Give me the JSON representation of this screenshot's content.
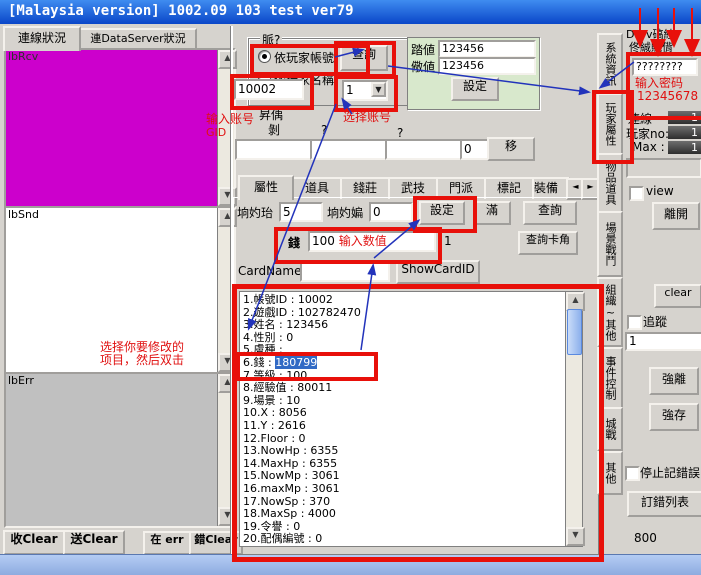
{
  "window": {
    "title": "[Malaysia version] 1002.09   103 test ver79"
  },
  "left_tabs": {
    "tab1": "連線狀況",
    "tab2": "連DataServer狀況"
  },
  "listboxes": {
    "rcv_label": "lbRcv",
    "snd_label": "lbSnd",
    "err_label": "lbErr"
  },
  "bottom_buttons": {
    "rcv_clear": "收Clear",
    "snd_clear": "送Clear",
    "err": "在 err",
    "err_clear": "錯Clear"
  },
  "query_group": {
    "title": "脈?",
    "radio_by_account": "依玩家帳號",
    "radio_by_name": "依玩家名稱",
    "query_button": "查詢",
    "account_value": "10002",
    "account_select_value": "1"
  },
  "value_group": {
    "row1_label": "踏値",
    "row1_value": "123456",
    "row2_label": "儆値",
    "row2_value": "123456",
    "set_button": "設定"
  },
  "transfer_row": {
    "label_top": "昇偊",
    "label_left": "剝",
    "q1": "?",
    "q2": "?",
    "input1": "",
    "input2": "",
    "input3": "",
    "count_value": "0",
    "move_button": "移"
  },
  "attr_tabs": {
    "tabs": [
      "屬性",
      "道具",
      "錢莊",
      "武技",
      "門派",
      "標記",
      "裝備"
    ]
  },
  "attribute_tab": {
    "field1_label": "垧妁珆",
    "field1_value": "5",
    "field2_label": "垧妁媥",
    "field2_value": "0",
    "set_button": "設定",
    "full_button": "滿",
    "query_button": "查詢",
    "money_label": "錢",
    "money_value": "100",
    "count_label": "1",
    "query_card_button": "查詢卡角",
    "cardname_label": "CardName",
    "cardname_value": "",
    "showcardid_button": "ShowCardID"
  },
  "player_list": {
    "items": [
      "1.帳號ID : 10002",
      "2.遊戲ID : 102782470",
      "3.姓名 : 123456",
      "4.性別 : 0",
      "5.膚種 :",
      "6.錢 : 180799",
      "7.等級 : 100",
      "8.經驗值 : 80011",
      "9.場景 : 10",
      "10.X : 8056",
      "11.Y : 2616",
      "12.Floor : 0",
      "13.NowHp : 6355",
      "14.MaxHp : 6355",
      "15.NowMp : 3061",
      "16.maxMp : 3061",
      "17.NowSp : 370",
      "18.MaxSp : 4000",
      "19.令譽 : 0",
      "20.配偶編號 : 0"
    ],
    "item6": {
      "prefix": "6.錢 : ",
      "value": "180799"
    }
  },
  "right_tabs": [
    "系統資訊",
    "玩家屬性",
    "物品道具",
    "場景戰鬥",
    "組織~其他",
    "事件控制",
    "城戰",
    "其他"
  ],
  "right_panel": {
    "ds_line1": "DSrv碻絓",
    "ds_line2": "佟絾賳偝",
    "password_value": "????????",
    "conn_label": "連線",
    "conn_value": "1",
    "playerno_label": "玩家no:",
    "playerno_value": "1",
    "max_label": "Max :",
    "max_value": "1",
    "view_label": "view",
    "leave_button": "離開",
    "clear_button": "clear",
    "track_label": "追蹤",
    "track_value": "1",
    "force_leave_button": "強離",
    "force_save_button": "強存",
    "stop_log_label": "停止記錯誤",
    "error_list_button": "訂錯列表",
    "port_value": "800"
  },
  "annotations": {
    "enter_account_line1": "输入账号",
    "enter_account_line2": "GID",
    "select_account": "选择账号",
    "enter_value": "输入数值",
    "enter_password": "输入密码",
    "password_hint": "12345678",
    "select_item_line1": "选择你要修改的",
    "select_item_line2": "项目，然后双击"
  },
  "icons": {
    "scroll_up": "▲",
    "scroll_down": "▼",
    "dropdown": "▼",
    "tab_scroll_left": "◄",
    "tab_scroll_right": "►"
  },
  "colors": {
    "titlebar_start": "#3f8cf0",
    "titlebar_end": "#0a46c8",
    "window_gray": "#d6d3ce",
    "magenta": "#cc00cc",
    "err_gray": "#c0c0c0",
    "annotation_red": "#e8100a",
    "arrow_blue": "#2233bb",
    "selection_blue": "#316ac5",
    "green_panel": "#d8e8cc",
    "taskbar_blue": "#a6c0ec"
  }
}
